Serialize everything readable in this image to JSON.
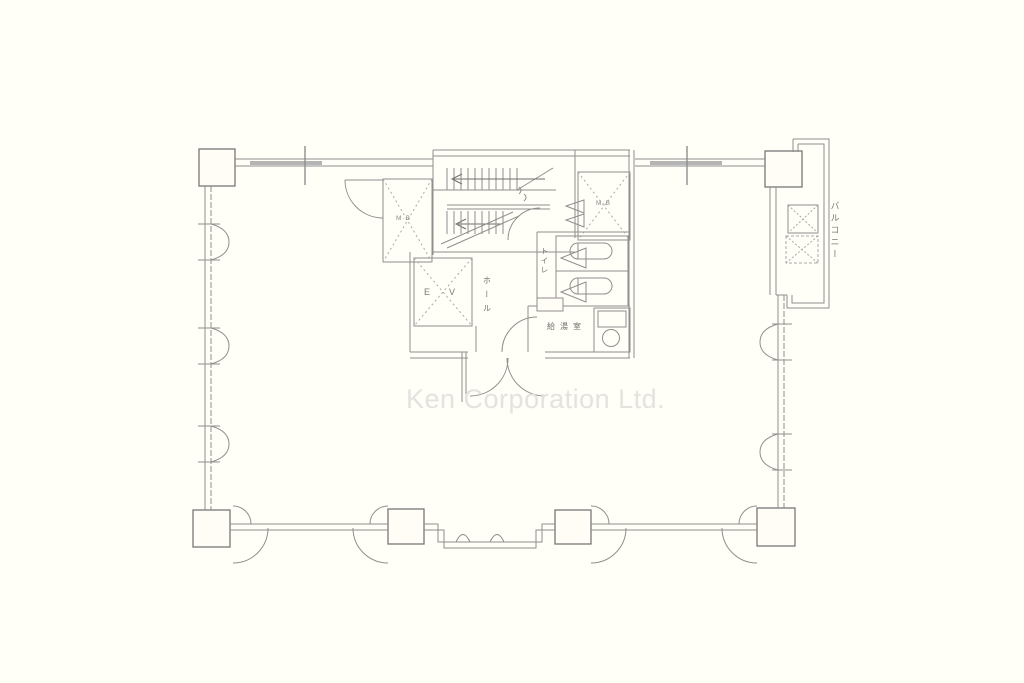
{
  "watermark": "Ken Corporation Ltd.",
  "plan": {
    "labels": {
      "balcony": "バルコニー",
      "toilet": "トイレ",
      "hall": "ホール",
      "kitchenette": "給湯室",
      "elevator": "EV",
      "meter_box_left": "M·B",
      "meter_box_right": "M·B"
    },
    "colors": {
      "background": "#fffef7",
      "line": "#8f8f8f",
      "line_dark": "#777777",
      "dashed": "#a8a8a8",
      "watermark": "#e3e3df",
      "label_text": "#6f6f6f"
    }
  }
}
